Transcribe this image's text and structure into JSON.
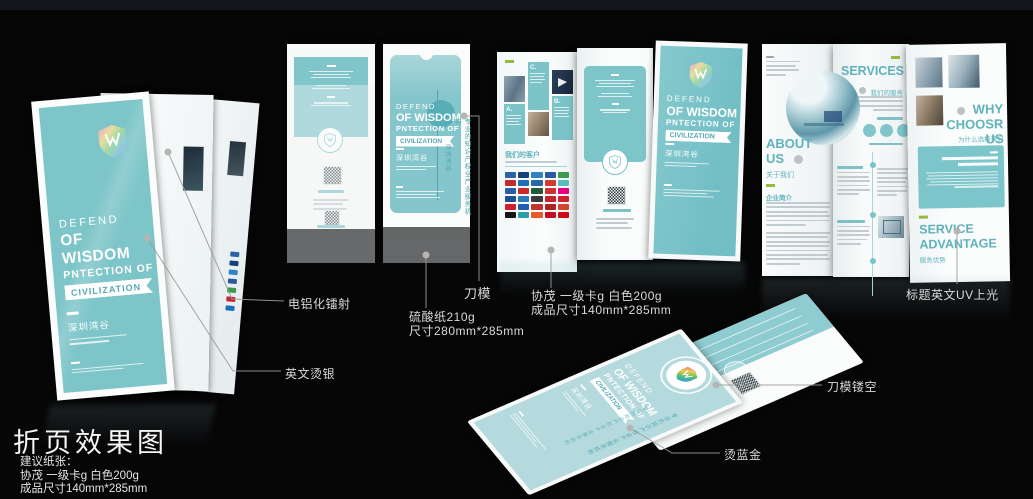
{
  "colors": {
    "teal": "#7dc5c9",
    "teal_light": "#b5dade",
    "teal_dark": "#58aeb6",
    "teal_text": "#5fb2bc",
    "green_accent": "#96ba3f",
    "annotation_text": "#d9d9d9",
    "holographic": [
      "#e7a6c8",
      "#f2e09a",
      "#9fd8a8",
      "#8fc7e8",
      "#b9a6e0"
    ],
    "rainbow": [
      "#e85d9a",
      "#f2c94c",
      "#57c06a",
      "#3aa0d8",
      "#7a5fd0"
    ]
  },
  "cover": {
    "line1": "DEFEND",
    "line2": "OF WISDOM",
    "line3": "PNTECTION OF",
    "ribbon": "CIVILIZATION",
    "brand": "深圳湾谷",
    "tagline_vertical": "专业的知识产权全产业服务机构"
  },
  "center_brochure": {
    "clients_heading": "我们的客户",
    "block_a": "A.",
    "block_b": "B.",
    "block_c": "C.",
    "logo_colors": [
      "#2c62a8",
      "#15407a",
      "#2f85c4",
      "#2b5aa0",
      "#3d9a4e",
      "#c22a30",
      "#1f6fb8",
      "#2a67a8",
      "#d03a2f",
      "#5bbcc0",
      "#2b5ea8",
      "#cc2a2a",
      "#1e5c3a",
      "#d0312f",
      "#e5007e",
      "#1e4f96",
      "#2a7ab8",
      "#3a3a3a",
      "#c2262c",
      "#d21f2e",
      "#cf1f2e",
      "#1f5fae",
      "#c23330",
      "#b02226",
      "#d2452f",
      "#141414",
      "#2aa0a8",
      "#e85a28",
      "#c00d20",
      "#d00a18"
    ]
  },
  "right_brochure": {
    "about_line1": "ABOUT",
    "about_line2": "US",
    "about_sub": "关于我们",
    "about_section": "企业简介",
    "services_title": "SERVICES",
    "services_sub": "我们的服务",
    "why_line1": "WHY",
    "why_line2": "CHOOSR US",
    "why_sub": "为什么选择我们",
    "adv_line1": "SERVICE",
    "adv_line2": "ADVANTAGE",
    "adv_sub": "服务优势"
  },
  "annotations": {
    "laser": "电铝化镭射",
    "silver_foil": "英文烫银",
    "die_line": "刀模",
    "paper_top": "硫酸纸210g",
    "paper_top_size": "尺寸280mm*285mm",
    "paper_main": "协茂 一级卡g 白色200g",
    "paper_main_size": "成品尺寸140mm*285mm",
    "uv": "标题英文UV上光",
    "die_cut": "刀模镂空",
    "foil_blue_gold": "烫蓝金"
  },
  "footer": {
    "title": "折页效果图",
    "note_label": "建议纸张：",
    "note_paper": "协茂 一级卡g 白色200g",
    "note_size": "成品尺寸140mm*285mm"
  }
}
